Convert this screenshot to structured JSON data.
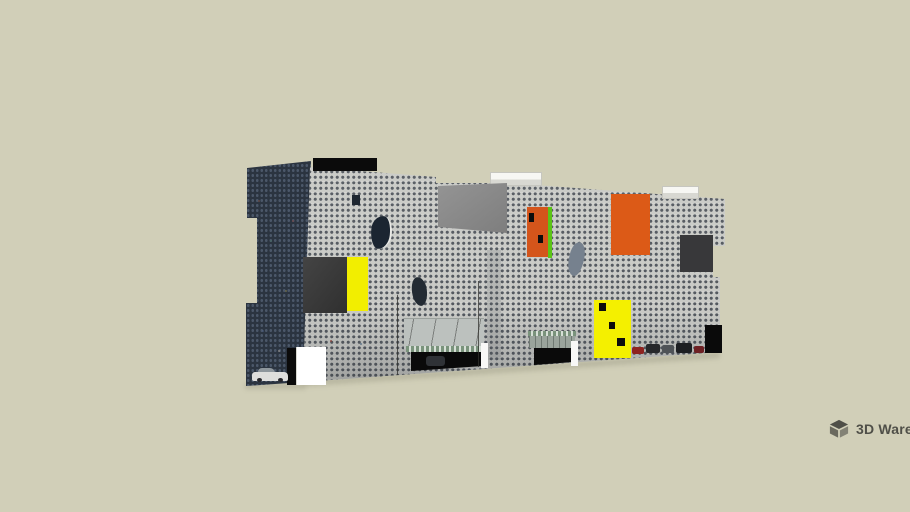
{
  "scene": {
    "background_color": "#D1CFB8",
    "description": "3D model preview of a long slab building with a dense grid-window facade, notched corners, and scattered colored accent panels"
  },
  "watermark": {
    "text": "3D Warehouse",
    "color": "#45453F"
  },
  "building": {
    "palette": {
      "facade_front": "#C9CAC6",
      "facade_left": "#2B3440",
      "roof_slab_black": "#0B0B0B",
      "roof_box_white": "#F7F7F3",
      "panel_gray": "#8C8C8C",
      "panel_black_left": "#3A3A3A",
      "panel_yellow_strip": "#F2EE00",
      "door_orange": "#D4551B",
      "door_green_edge": "#5BC416",
      "panel_orange_large": "#DC5A17",
      "panel_dark_right": "#38383A",
      "panel_yellow_large": "#F4F000",
      "panel_dot_black": "#0D0D0D",
      "window_dark": "#1B2531",
      "window_dark_2": "#232B33",
      "window_blob_gray": "#76818E",
      "window_small_dark": "#1E2630",
      "canopy_gray": "#BCC1BE",
      "awning_green": "#7A937C",
      "recess_black": "#0A0A0A",
      "pillar_white": "#F8F8F6",
      "corner_black": "#0A0A0A",
      "strip_black": "#0B0B0B",
      "block_white": "#FFFFFF",
      "vehicle_dark": "#2F3236",
      "car_white": "#DEDEDC",
      "car_red": "#8E2320",
      "car_dark": "#26282B",
      "car_gray": "#4F5357",
      "car_dark_2": "#1D1F22",
      "car_maroon": "#6E2124"
    }
  }
}
